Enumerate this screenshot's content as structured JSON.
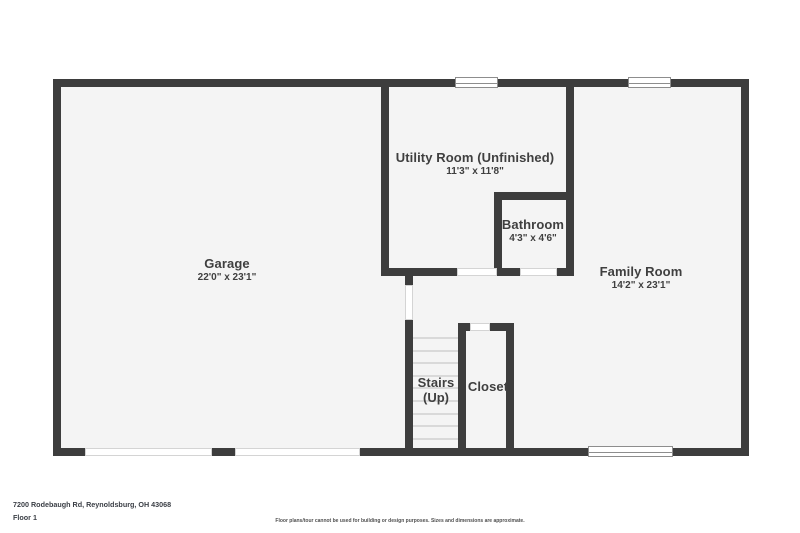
{
  "plan": {
    "rooms": [
      {
        "id": "garage",
        "name": "Garage",
        "dims": "22'0\" x 23'1\"",
        "cx": 227,
        "cy": 264
      },
      {
        "id": "utility-room",
        "name": "Utility Room (Unfinished)",
        "dims": "11'3\" x 11'8\"",
        "cx": 475,
        "cy": 158
      },
      {
        "id": "bathroom",
        "name": "Bathroom",
        "dims": "4'3\" x 4'6\"",
        "cx": 533,
        "cy": 225
      },
      {
        "id": "family-room",
        "name": "Family Room",
        "dims": "14'2\" x 23'1\"",
        "cx": 641,
        "cy": 272
      },
      {
        "id": "stairs",
        "name": "Stairs",
        "dims": "(Up)",
        "cx": 436,
        "cy": 383
      },
      {
        "id": "closet",
        "name": "Closet",
        "dims": "",
        "cx": 488,
        "cy": 387
      }
    ]
  },
  "footer": {
    "address": "7200 Rodebaugh Rd, Reynoldsburg, OH 43068",
    "floor_label": "Floor 1",
    "disclaimer": "Floor plans/tour cannot be used for building or design purposes. Sizes and dimensions are approximate."
  },
  "colors": {
    "wall": "#3d3d3d",
    "floor": "#f4f4f4",
    "label_text": "#3f3f3f"
  }
}
